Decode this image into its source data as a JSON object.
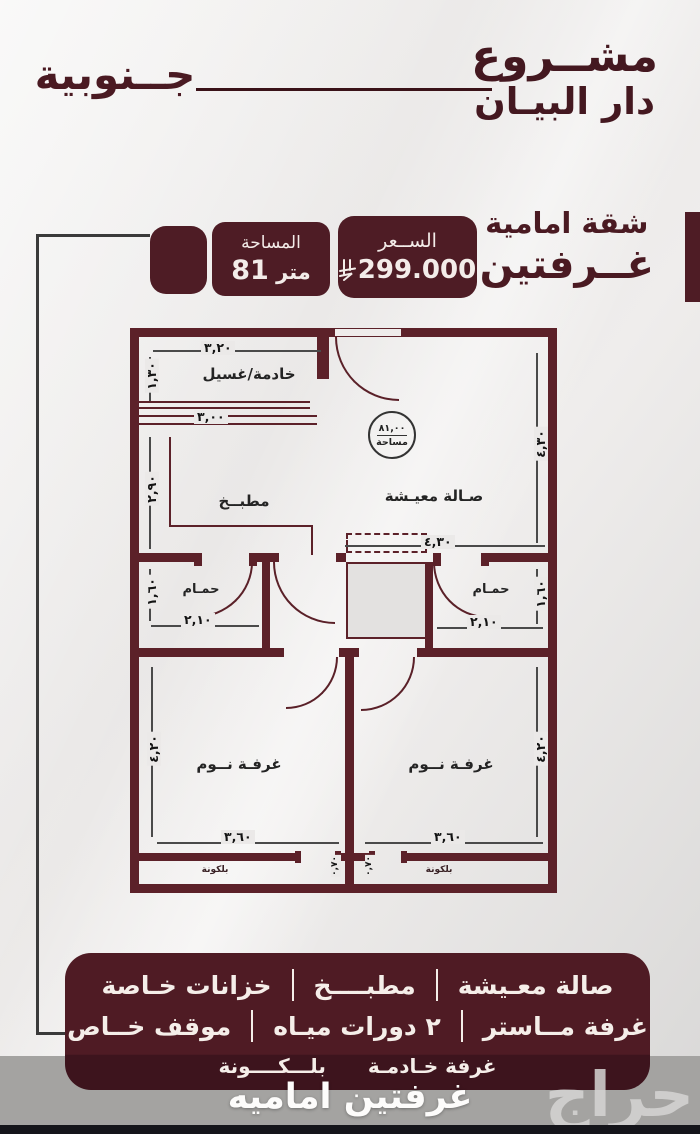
{
  "header": {
    "project_label": "مشــروع",
    "project_name": "دار البيـان",
    "orientation": "جــنوبية"
  },
  "badges": {
    "area_label": "المساحة",
    "area_value": "81",
    "area_unit": "متر",
    "price_label": "الســعر",
    "price_value": "299.000",
    "apartment_type_line1": "شقة امامية",
    "apartment_type_line2": "غــرفتين"
  },
  "floor_plan": {
    "stamp": {
      "value": "٨١,٠٠",
      "label": "مساحة"
    },
    "rooms": {
      "maid_laundry": "خادمة/غسيل",
      "kitchen": "مطبــخ",
      "living": "صـالة معيـشة",
      "bath_left": "حمـام",
      "bath_right": "حمـام",
      "bed_left": "غرفـة نــوم",
      "bed_right": "غرفـة نــوم",
      "balcony_left": "بلكونة",
      "balcony_right": "بلكونة"
    },
    "dims": {
      "maid_w": "٣,٢٠",
      "maid_h": "١,٣٠",
      "counter_w": "٣,٠٠",
      "kitchen_h": "٢,٩٠",
      "living_w": "٤,٣٠",
      "living_h": "٤,٣٠",
      "bath_left_w": "٢,١٠",
      "bath_left_h": "١,٦٠",
      "bath_right_w": "٢,١٠",
      "bath_right_h": "١,٦٠",
      "bed_left_w": "٣,٦٠",
      "bed_left_h": "٤,٢٠",
      "bed_right_w": "٣,٦٠",
      "bed_right_h": "٤,٢٠",
      "balcony_left_d": "٠,٧٠",
      "balcony_right_d": "٠,٧٠"
    }
  },
  "features": {
    "row1": [
      "صالة معـيشة",
      "مطبــــخ",
      "خزانات خـاصة"
    ],
    "row2": [
      "غرفة مــاستر",
      "٢ دورات ميـاه",
      "موقف خــاص"
    ],
    "row3": [
      "غرفة خـادمـة",
      "بلـــكــــونة"
    ]
  },
  "footer": {
    "caption": "غرفتين اماميه",
    "watermark": "حراج"
  },
  "colors": {
    "maroon": "#4e1c25",
    "wall": "#5c2129",
    "gray_band": "#a4a3a1",
    "cream_text": "#f5eee9"
  }
}
